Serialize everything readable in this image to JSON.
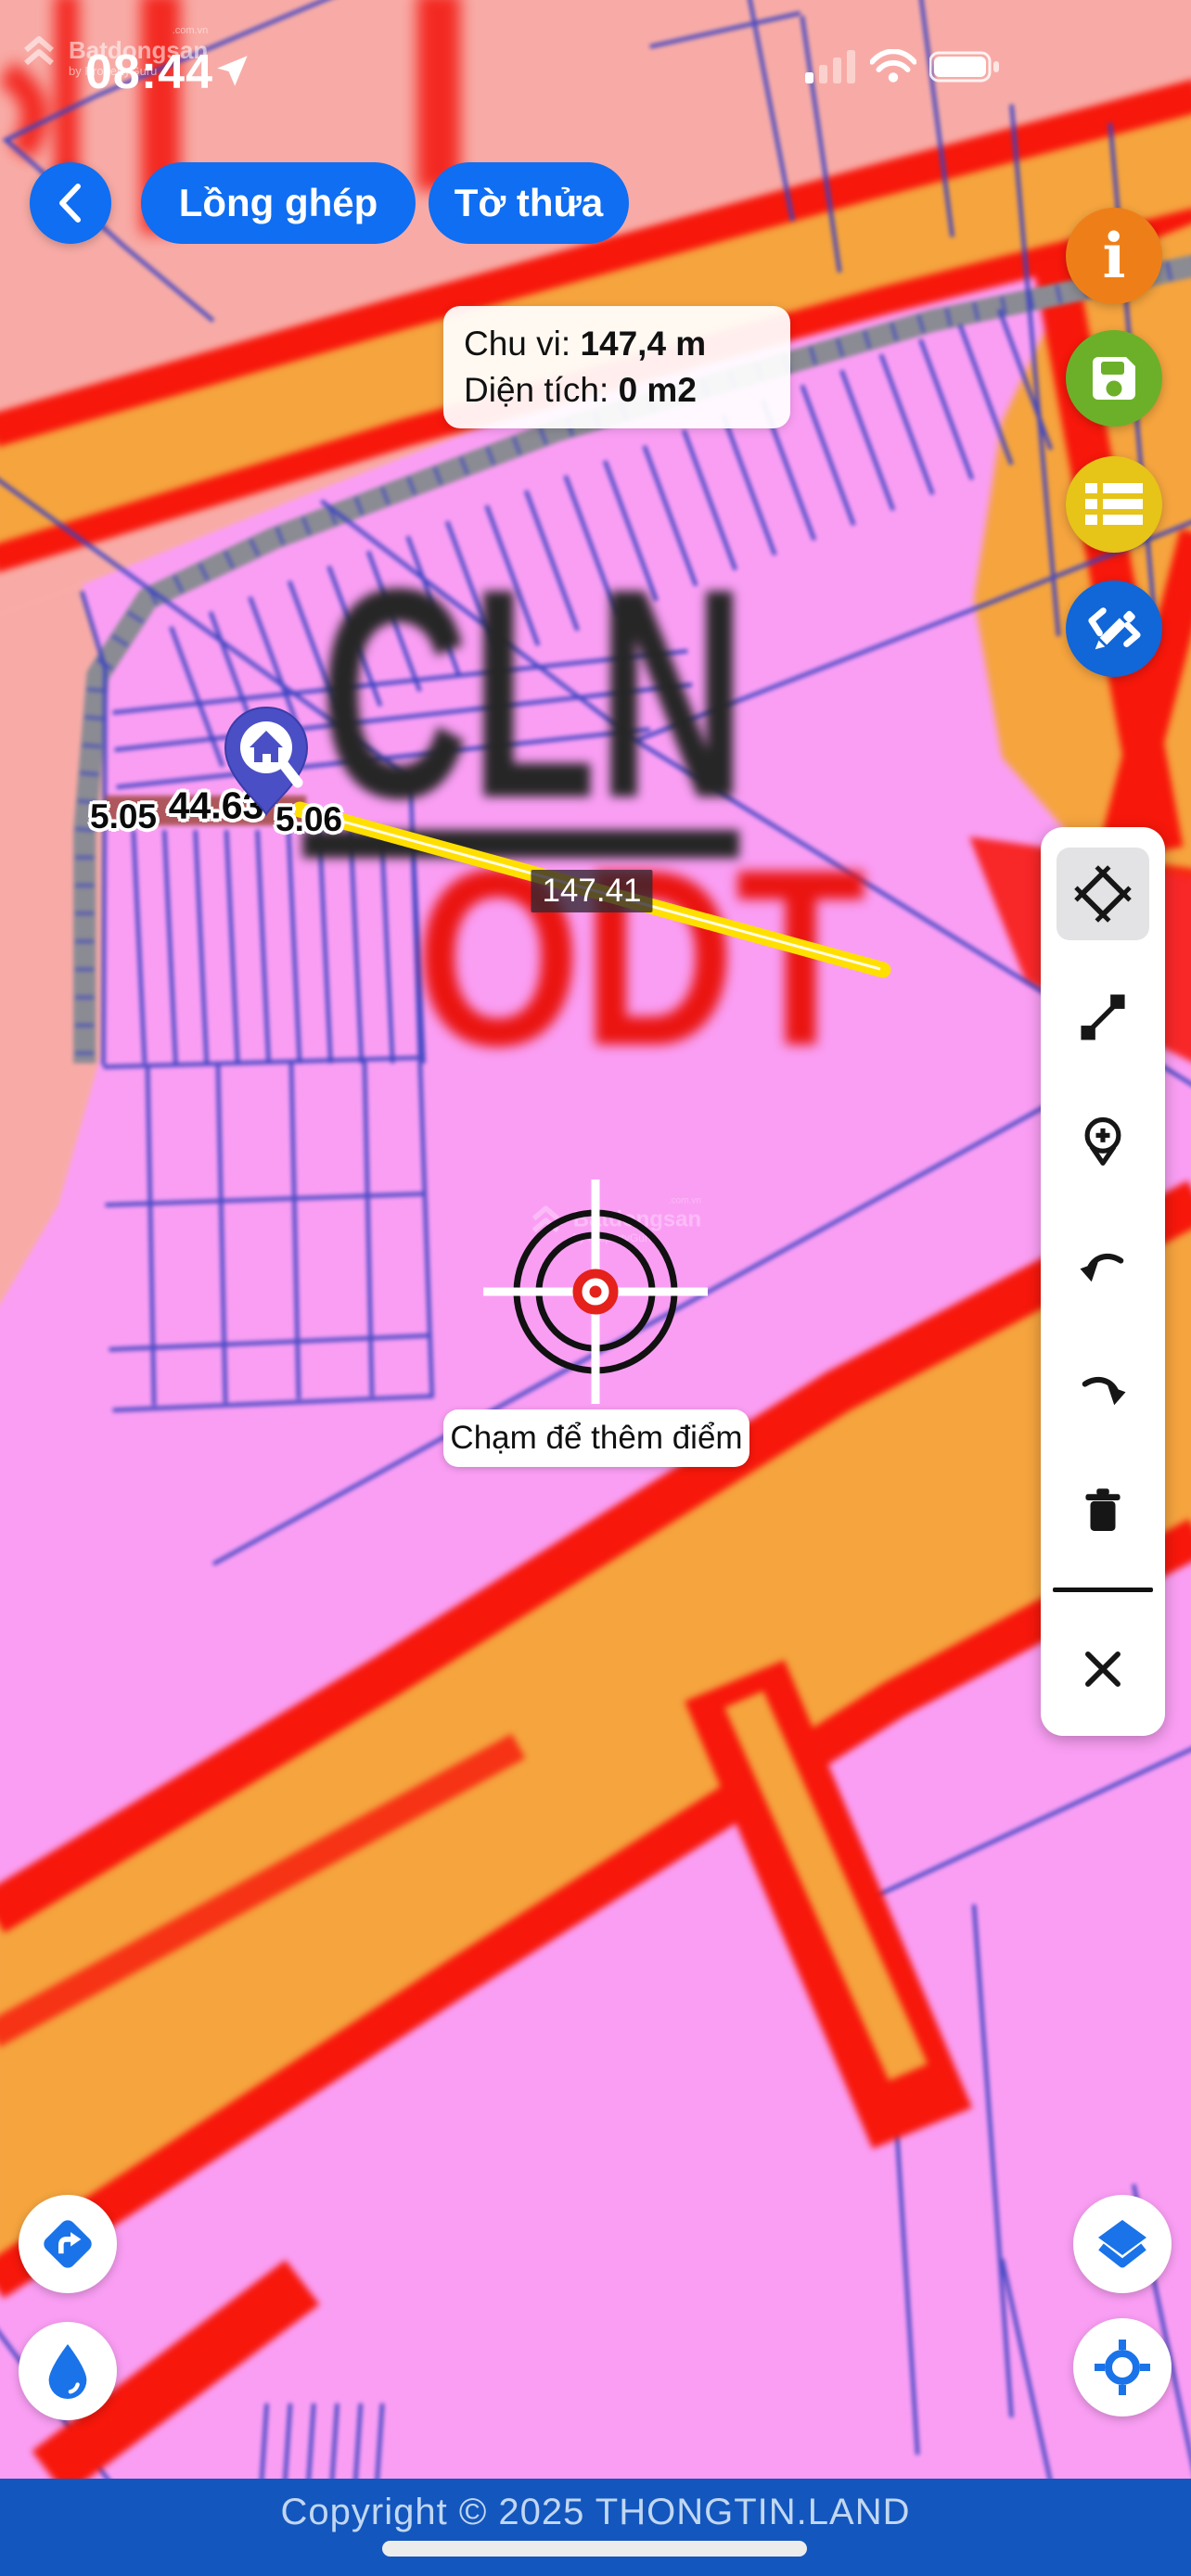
{
  "status_bar": {
    "time": "08:44"
  },
  "watermark": {
    "domain": ".com.vn",
    "brand": "Batdongsan",
    "byline": "by PropertyGuru"
  },
  "header": {
    "lo_ghep_label": "Lồng ghép",
    "to_thua_label": "Tờ thửa"
  },
  "info_card": {
    "perimeter_label": "Chu vi: ",
    "perimeter_value": "147,4 m",
    "area_label": "Diện tích: ",
    "area_value": "0 m2"
  },
  "map": {
    "zone_label_cln": "CLN",
    "zone_label_odt": "ODT",
    "measurement": {
      "segment_1": "5.05",
      "segment_2": "44.63",
      "segment_3": "5.06",
      "total_length": "147.41"
    },
    "hint_label": "Chạm để thêm điểm",
    "colors": {
      "zone_salmon": "#f8aba6",
      "zone_magenta": "#fa9ef4",
      "road_orange": "#f5a43e",
      "road_red": "#f7170b",
      "parcel_line_blue": "#3b43c2",
      "road_gray": "#8b8b94",
      "measure_segment_maroon": "#a7514e",
      "measure_line_yellow": "#ffdf00",
      "pin_indigo": "#4b4fc5"
    }
  },
  "action_buttons": {
    "info": {
      "color": "#ee7f18",
      "glyph": "i"
    },
    "save": {
      "color": "#6cb02a"
    },
    "list": {
      "color": "#e6c418"
    },
    "draw": {
      "color": "#1166d8"
    }
  },
  "tool_panel": {
    "tools": [
      "area-measure",
      "line-measure",
      "add-point",
      "undo",
      "redo",
      "delete",
      "close"
    ]
  },
  "footer": {
    "copyright": "Copyright © 2025 THONGTIN.LAND"
  }
}
